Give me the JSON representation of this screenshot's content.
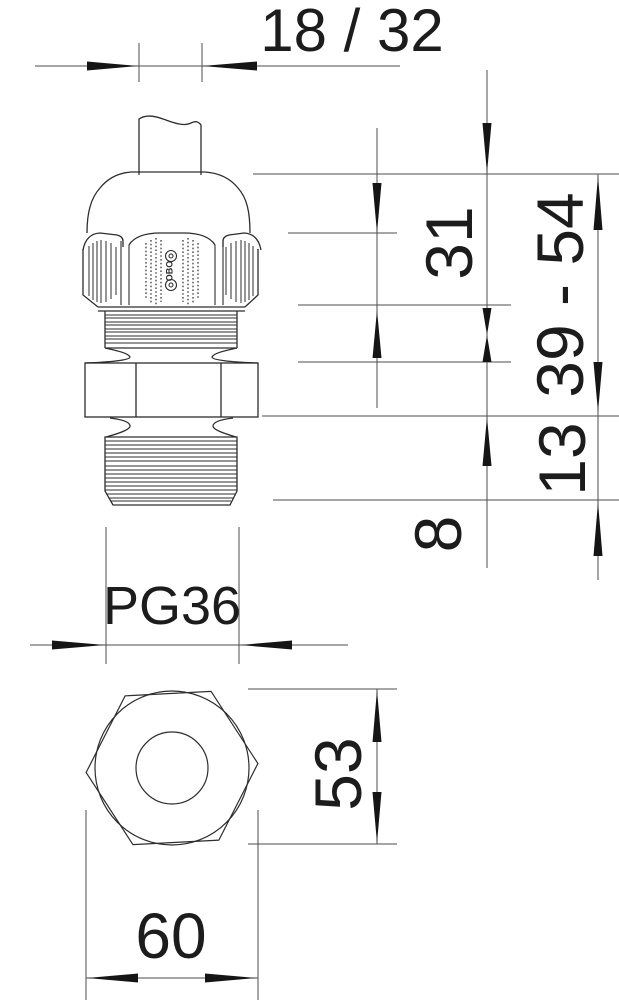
{
  "labels": {
    "dim_top": "18 / 32",
    "dim_cap": "31",
    "dim_range": "39 - 54",
    "dim_13": "13",
    "dim_8": "8",
    "dim_thread": "PG36",
    "dim_side": "53",
    "dim_width": "60",
    "logo": "OBO"
  },
  "colors": {
    "background": "#ffffff",
    "outline": "#2d2d2d",
    "dim_line": "#4d4d4d",
    "ink": "#151515"
  }
}
